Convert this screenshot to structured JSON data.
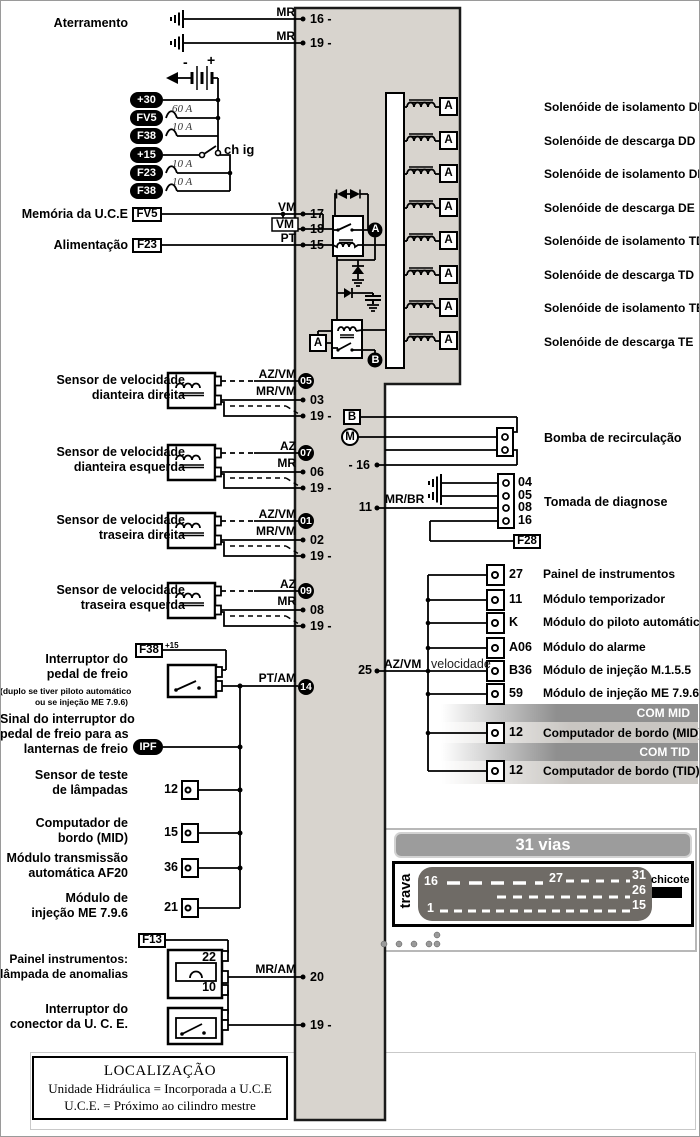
{
  "colors": {
    "band_gray": "#d8d4ce",
    "banner_gray": "#9c9c9c",
    "connector_dark": "#6f6b66",
    "wire_black": "#000000"
  },
  "icons": {
    "ground-icon": "earth-bars",
    "battery-icon": "cells",
    "motor-icon": "M-circle",
    "coil-icon": "inductor",
    "switch-icon": "blade-contact",
    "lamp-icon": "loop"
  },
  "top": {
    "ground_label": "Aterramento",
    "wire1": "MR",
    "wire2": "MR",
    "pin1": "16 -",
    "pin2": "19 -"
  },
  "power": {
    "battery_minus": "-",
    "battery_plus": "+",
    "switch_label": "ch ig",
    "tags": [
      "+30",
      "FV5",
      "F38",
      "+15",
      "F23",
      "F38"
    ],
    "ratings": [
      "60 A",
      "10 A",
      "10 A",
      "10 A"
    ]
  },
  "memoria": {
    "label": "Memória da U.C.E",
    "fuse": "FV5",
    "w1": "VM",
    "w2": "VM",
    "w3": "PT",
    "p1": "17",
    "p2": "18",
    "p3": "15"
  },
  "alimentacao": {
    "label": "Alimentação",
    "fuse": "F23"
  },
  "relay": {
    "badge_a": "A",
    "badge_b": "B",
    "abox": "A"
  },
  "solenoids": {
    "a": "A",
    "items": [
      "Solenóide de isolamento DD",
      "Solenóide de descarga DD",
      "Solenóide de isolamento DE",
      "Solenóide de descarga DE",
      "Solenóide de isolamento TD",
      "Solenóide de descarga TD",
      "Solenóide de isolamento TE",
      "Solenóide de descarga TE"
    ]
  },
  "sensors": [
    {
      "l1": "Sensor de velocidade",
      "l2": "dianteira direita",
      "w1": "AZ/VM",
      "w2": "MR/VM",
      "p1": "05",
      "p2": "03",
      "p3": "19 -"
    },
    {
      "l1": "Sensor de velocidade",
      "l2": "dianteira esquerda",
      "w1": "AZ",
      "w2": "MR",
      "p1": "07",
      "p2": "06",
      "p3": "19 -"
    },
    {
      "l1": "Sensor de velocidade",
      "l2": "traseira direita",
      "w1": "AZ/VM",
      "w2": "MR/VM",
      "p1": "01",
      "p2": "02",
      "p3": "19 -"
    },
    {
      "l1": "Sensor de velocidade",
      "l2": "traseira esquerda",
      "w1": "AZ",
      "w2": "MR",
      "p1": "09",
      "p2": "08",
      "p3": "19 -"
    }
  ],
  "bomba": {
    "b": "B",
    "m": "M",
    "pin": "- 16",
    "label": "Bomba de recirculação"
  },
  "diagnose": {
    "pin": "11",
    "wire": "MR/BR",
    "pins": [
      "04",
      "05",
      "08",
      "16"
    ],
    "label": "Tomada de diagnose",
    "fuse": "F28"
  },
  "speed": {
    "pin": "25",
    "wire": "AZ/VM",
    "tag": "velocidade",
    "mid_banner": "COM MID",
    "tid_banner": "COM TID",
    "rows": [
      {
        "pin": "27",
        "label": "Painel de instrumentos"
      },
      {
        "pin": "11",
        "label": "Módulo temporizador"
      },
      {
        "pin": "K",
        "label": "Módulo do piloto automático"
      },
      {
        "pin": "A06",
        "label": "Módulo do alarme"
      },
      {
        "pin": "B36",
        "label": "Módulo de injeção M.1.5.5"
      },
      {
        "pin": "59",
        "label": "Módulo de injeção ME 7.9.6"
      },
      {
        "pin": "12",
        "label": "Computador de bordo (MID)"
      },
      {
        "pin": "12",
        "label": "Computador de bordo (TID)"
      }
    ]
  },
  "brake": {
    "fuse": "F38",
    "sup": "+15",
    "l1": "Interruptor do",
    "l2": "pedal de freio",
    "sub1": "(duplo se tiver piloto automático",
    "sub2": "ou se injeção ME 7.9.6)",
    "wire": "PT/AM",
    "pin": "14",
    "ipf": "IPF",
    "s1": "Sinal do interruptor do",
    "s2": "pedal de freio para as",
    "s3": "lanternas de freio",
    "rows": [
      {
        "pin": "12",
        "l1": "Sensor de teste",
        "l2": "de lâmpadas"
      },
      {
        "pin": "15",
        "l1": "Computador de",
        "l2": "bordo (MID)"
      },
      {
        "pin": "36",
        "l1": "Módulo transmissão",
        "l2": "automática AF20"
      },
      {
        "pin": "21",
        "l1": "Módulo de",
        "l2": "injeção ME 7.9.6"
      }
    ]
  },
  "lamp": {
    "fuse": "F13",
    "l1": "Painel instrumentos:",
    "l2": "lâmpada de anomalias",
    "p_top": "22",
    "p_bot": "10",
    "wire": "MR/AM",
    "pin": "20"
  },
  "uce": {
    "l1": "Interruptor do",
    "l2": "conector da U. C. E.",
    "pin": "19 -"
  },
  "conn31": {
    "title": "31  vias",
    "trava": "trava",
    "n16": "16",
    "n27": "27",
    "n31": "31",
    "n26": "26",
    "n15": "15",
    "n1": "1",
    "chicote": "chicote"
  },
  "loc": {
    "title": "LOCALIZAÇÃO",
    "line1": "Unidade Hidráulica = Incorporada a U.C.E",
    "line2": "U.C.E. = Próximo ao cilindro mestre"
  }
}
